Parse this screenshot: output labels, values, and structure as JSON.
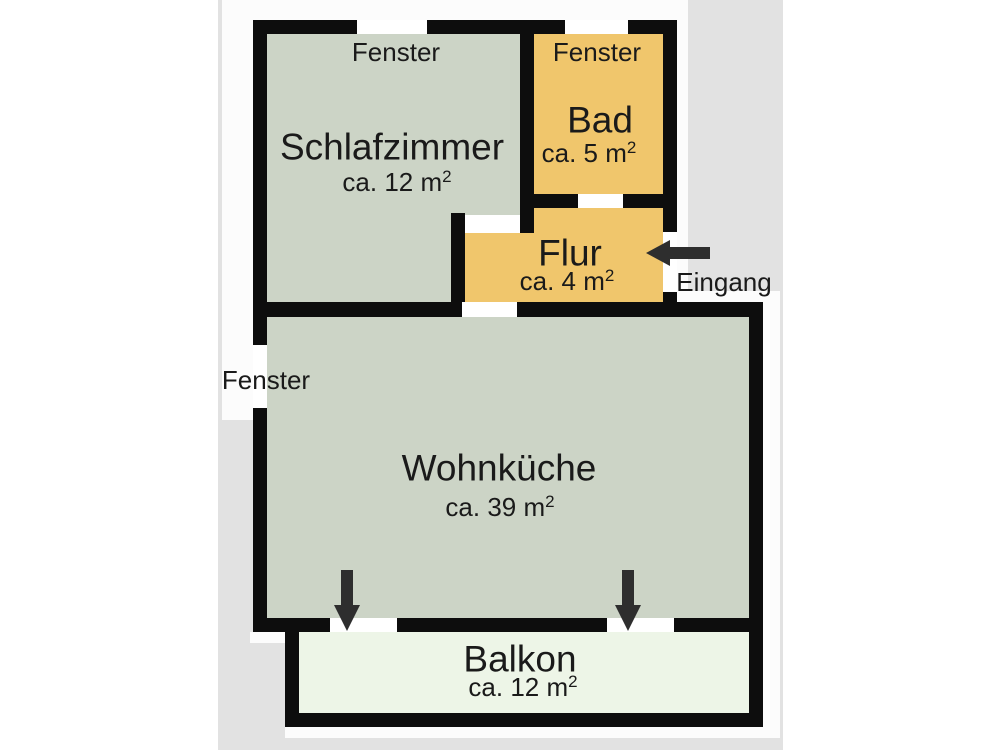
{
  "plan": {
    "rooms": {
      "schlafzimmer": {
        "name": "Schlafzimmer",
        "area_text": "ca. 12 m",
        "area_sup": "2"
      },
      "bad": {
        "name": "Bad",
        "area_text": "ca. 5 m",
        "area_sup": "2"
      },
      "flur": {
        "name": "Flur",
        "area_text": "ca. 4 m",
        "area_sup": "2"
      },
      "wohnkueche": {
        "name": "Wohnküche",
        "area_text": "ca. 39 m",
        "area_sup": "2"
      },
      "balkon": {
        "name": "Balkon",
        "area_text": "ca. 12 m",
        "area_sup": "2"
      }
    },
    "labels": {
      "window": "Fenster",
      "entrance": "Eingang"
    },
    "colors": {
      "wall": "#0d0d0d",
      "living_room_fill": "#ccd4c6",
      "wet_room_fill": "#f0c66c",
      "balcony_fill": "#edf5e7",
      "photo_background": "#e2e2e2",
      "canvas_white": "#fcfcfc",
      "arrow": "#2e2e2e",
      "text": "#1a1a1a"
    }
  }
}
